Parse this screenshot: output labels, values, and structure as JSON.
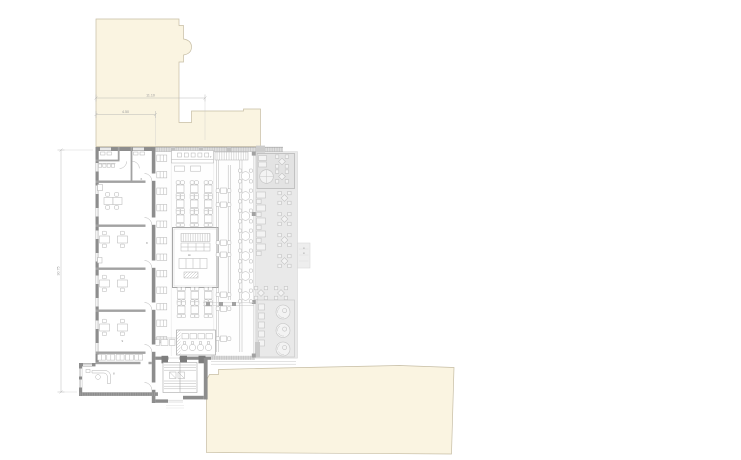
{
  "colors": {
    "site_fill": "#faf4e1",
    "site_stroke": "#c6bda4",
    "terrace_fill": "#e9e9e9",
    "terrace_stroke": "#d2d2d2",
    "wall_dark": "#8d8d8d",
    "wall_mid": "#a2a2a2",
    "line_grey": "#b5b5b5",
    "dim_grey": "#b3b3b3"
  },
  "dimensions": {
    "width_total": "11.10",
    "width_left": "4.50",
    "height_total": "30.75"
  },
  "room_labels": {
    "corridor": "6",
    "office_mid": "8",
    "bar": "7",
    "office_low": "9",
    "reception": "8"
  }
}
